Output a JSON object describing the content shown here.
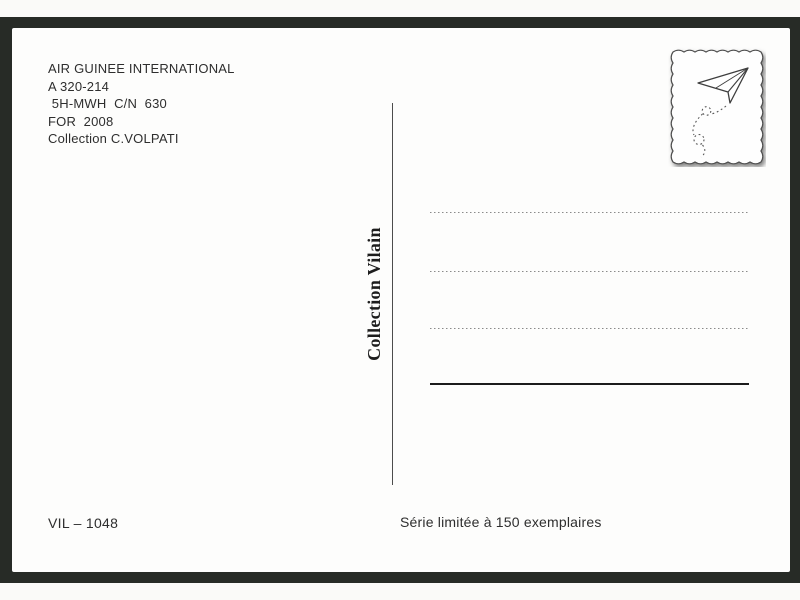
{
  "postcard": {
    "info_lines": [
      "AIR GUINEE INTERNATIONAL",
      "A 320-214",
      " 5H-MWH  C/N  630",
      "FOR  2008",
      "Collection C.VOLPATI"
    ],
    "collection_label": "Collection Vilain",
    "catalog_number": "VIL – 1048",
    "edition_note": "Série limitée à 150 exemplaires",
    "stamp": {
      "icon": "paper-plane-icon",
      "border_style": "wavy-stamp-edge"
    },
    "address_lines": {
      "dotted_count": 3,
      "solid_count": 1
    },
    "colors": {
      "backdrop": "#272b26",
      "card": "#fdfdfc",
      "ink": "#2e2e2e",
      "divider": "#4c4c4c",
      "dotted_line": "#8a8a8a",
      "solid_line": "#1c1c1c"
    }
  }
}
